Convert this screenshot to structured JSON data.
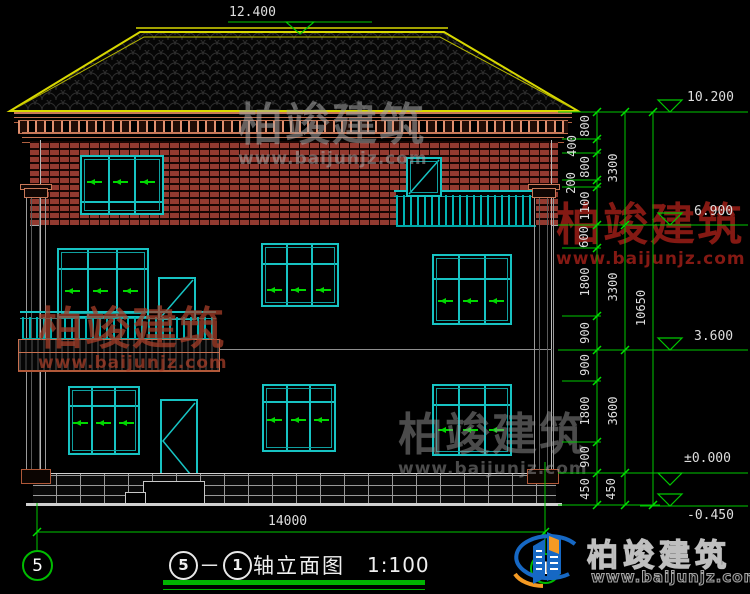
{
  "drawing": {
    "title": {
      "axis_start": "5",
      "dash": "－",
      "axis_end": "1",
      "name": "轴立面图",
      "scale": "1:100"
    },
    "bottom_width_dim": "14000",
    "levels": {
      "ridge": "12.400",
      "eaves": "10.200",
      "floor3": "6.900",
      "floor2": "3.600",
      "zero": "±0.000",
      "ground": "-0.450"
    },
    "right_dims": {
      "inner": [
        "800",
        "400",
        "800",
        "200",
        "1100",
        "600",
        "1800",
        "900",
        "900",
        "1800",
        "900",
        "450"
      ],
      "middle": [
        "3300",
        "3300",
        "3600",
        "450"
      ],
      "total": "10650"
    },
    "axis_bubbles": {
      "left": "5",
      "right": "1"
    }
  },
  "watermark": {
    "name": "柏竣建筑",
    "url": "www.baijunjz.com"
  },
  "logo": {
    "name": "柏竣建筑",
    "url": "www.baijunjz.com"
  },
  "colors": {
    "dim_green": "#00c800",
    "window_cyan": "#17c3c3",
    "brick_red": "#933a30",
    "roof_yellow": "#d8d800",
    "cornice_brown": "#c87050",
    "logo_blue": "#1668c4",
    "logo_orange": "#f59a23"
  }
}
